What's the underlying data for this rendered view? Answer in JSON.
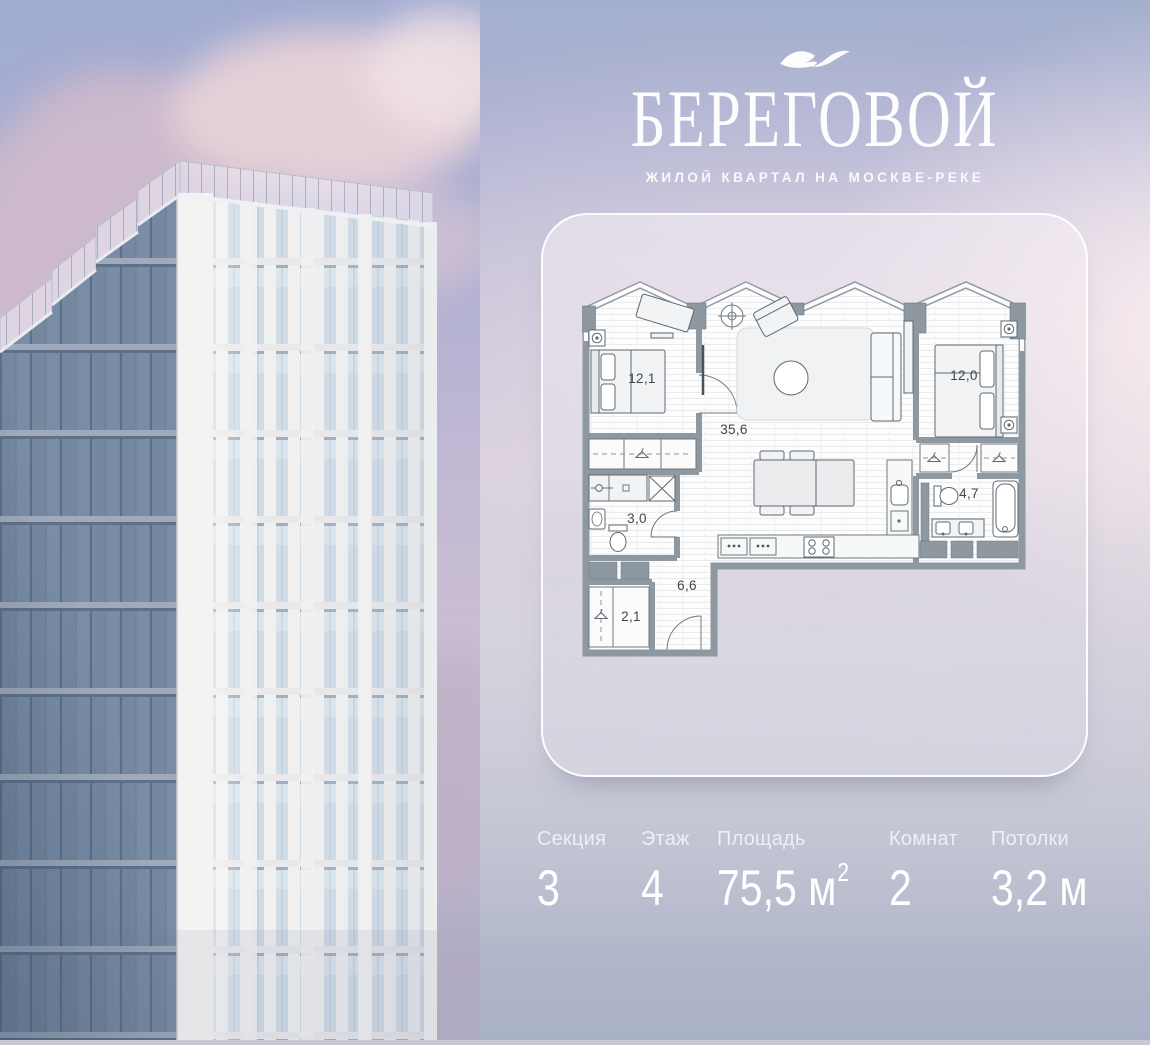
{
  "brand": {
    "title": "БЕРЕГОВОЙ",
    "subtitle": "ЖИЛОЙ КВАРТАЛ НА МОСКВЕ-РЕКЕ"
  },
  "plan": {
    "rooms": [
      {
        "id": "bedroom-1",
        "area": "12,1"
      },
      {
        "id": "living-kitchen",
        "area": "35,6"
      },
      {
        "id": "bedroom-2",
        "area": "12,0"
      },
      {
        "id": "bathroom-1",
        "area": "4,7"
      },
      {
        "id": "bathroom-2",
        "area": "3,0"
      },
      {
        "id": "hallway",
        "area": "6,6"
      },
      {
        "id": "wardrobe",
        "area": "2,1"
      }
    ]
  },
  "stats": [
    {
      "label": "Секция",
      "value": "3"
    },
    {
      "label": "Этаж",
      "value": "4"
    },
    {
      "label": "Площадь",
      "value": "75,5 м",
      "sup": "2"
    },
    {
      "label": "Комнат",
      "value": "2"
    },
    {
      "label": "Потолки",
      "value": "3,2 м"
    }
  ],
  "colors": {
    "wall": "#8e98a1",
    "label_ink": "#3f464c",
    "text": "#ffffff",
    "sky_top": "#a0abd1",
    "cloud_pink": "#e8d2d8"
  }
}
